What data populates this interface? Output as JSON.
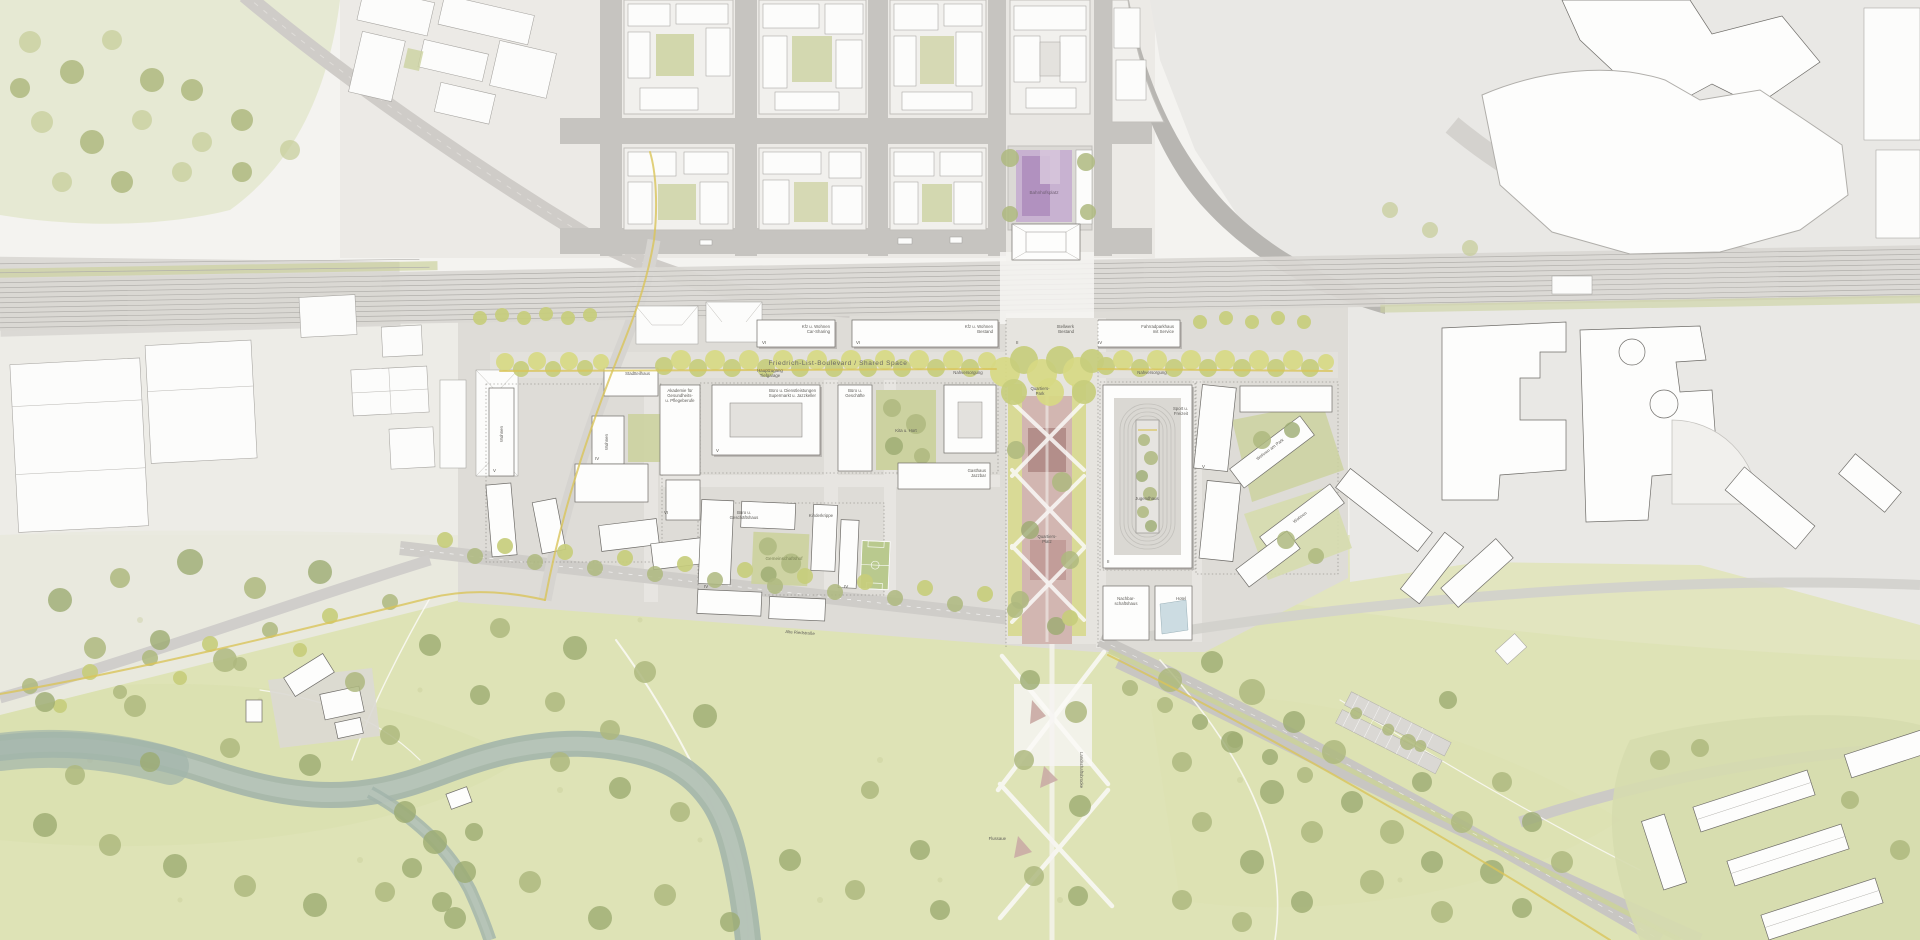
{
  "map": {
    "colors": {
      "park_green": "#ccd2a0",
      "axis_pink": "#c9a8a4",
      "station_purple": "#b79ec2",
      "water": "#a3b5ab",
      "bike_yellow": "#d9c45a"
    },
    "labels": {
      "boulevard": "Friedrich-List-Boulevard / Shared Space",
      "station_square": "Bahnhofsplatz",
      "row1": [
        "Kfz u. Wohnen",
        "Car-Sharing"
      ],
      "row2": [
        "Kfz u. Wohnen",
        "Bestand"
      ],
      "row3": [
        "Stellwerk",
        "Bestand"
      ],
      "row4": [
        "Fahrradparkhaus",
        "mit Service"
      ],
      "access1": [
        "Hauptzugang",
        "Tiefgarage"
      ],
      "nahversorgung": "Nahversorgung",
      "stadtteilhaus": "Stadtteilhaus",
      "akademie": [
        "Akademie für",
        "Gesundheits-",
        "u. Pflegeberufe"
      ],
      "buero_dienst": [
        "Büro u. Dienstleistungen",
        "Supermarkt u. Jazzkeller"
      ],
      "buero_geschaefte": [
        "Büro u.",
        "Geschäfte"
      ],
      "gasthaus": [
        "Gasthaus",
        "Jazzbar"
      ],
      "kita": "Kita u. Hort",
      "kinderkrippe": "Kinderkrippe",
      "gemeinschaftshof": "Gemeinschaftshof",
      "buero_geschaeftshaus": [
        "Büro u.",
        "Geschäftshaus"
      ],
      "wohnen": "Wohnen",
      "quartierspark": [
        "Quartiers-",
        "Park"
      ],
      "quartiersplatz": [
        "Quartiers-",
        "Platz"
      ],
      "sport": [
        "Sport u.",
        "Freizeit"
      ],
      "jugendhaus": "Jugendhaus",
      "nachbarschaftshaus": [
        "Nachbar-",
        "schaftshaus"
      ],
      "hotel": "Hotel",
      "wohnen_am_park": "Wohnen am Park",
      "landschaftsbruecke": "Landschaftsbrücke",
      "flussaue": "Flussaue",
      "south_street": "Alte Riedstraße"
    },
    "storeys": [
      "VI",
      "VI",
      "II",
      "IV",
      "V",
      "IV",
      "VI",
      "V",
      "IV",
      "IV",
      "II",
      "V"
    ]
  }
}
